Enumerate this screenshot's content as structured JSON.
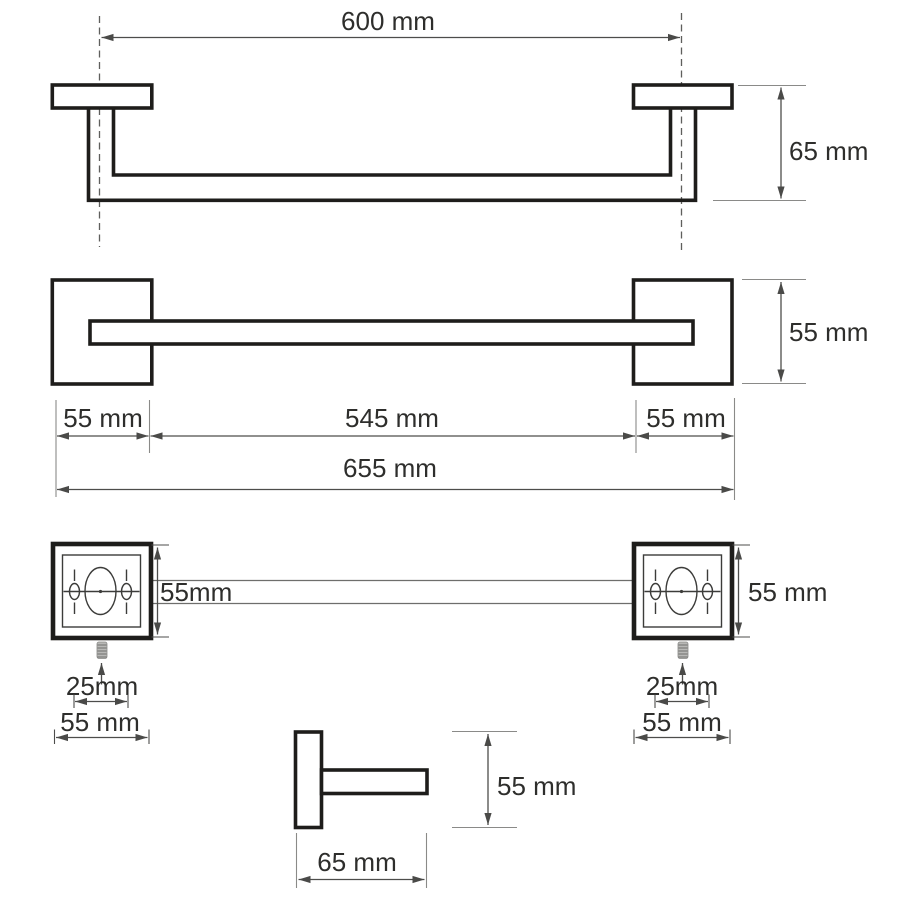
{
  "drawing": {
    "type": "technical-dimension-drawing",
    "subject": "wall-mounted towel bar with square mounting plates",
    "colors": {
      "background": "#ffffff",
      "shape_line": "#1e1d1b",
      "dimension_line": "#4d4d4b",
      "extension_line": "#8a8a88",
      "text": "#2e2e2c"
    },
    "top": {
      "length": "600 mm",
      "depth": "65 mm"
    },
    "front": {
      "plate_height": "55 mm",
      "left_plate_width": "55 mm",
      "bar_length": "545 mm",
      "right_plate_width": "55 mm",
      "total_length": "655 mm"
    },
    "detail_left": {
      "plate_height": "55mm",
      "screw_length": "25mm",
      "plate_width": "55 mm"
    },
    "detail_right": {
      "plate_height": "55 mm",
      "screw_length": "25mm",
      "plate_width": "55 mm"
    },
    "bracket": {
      "height": "55 mm",
      "depth": "65 mm"
    }
  }
}
